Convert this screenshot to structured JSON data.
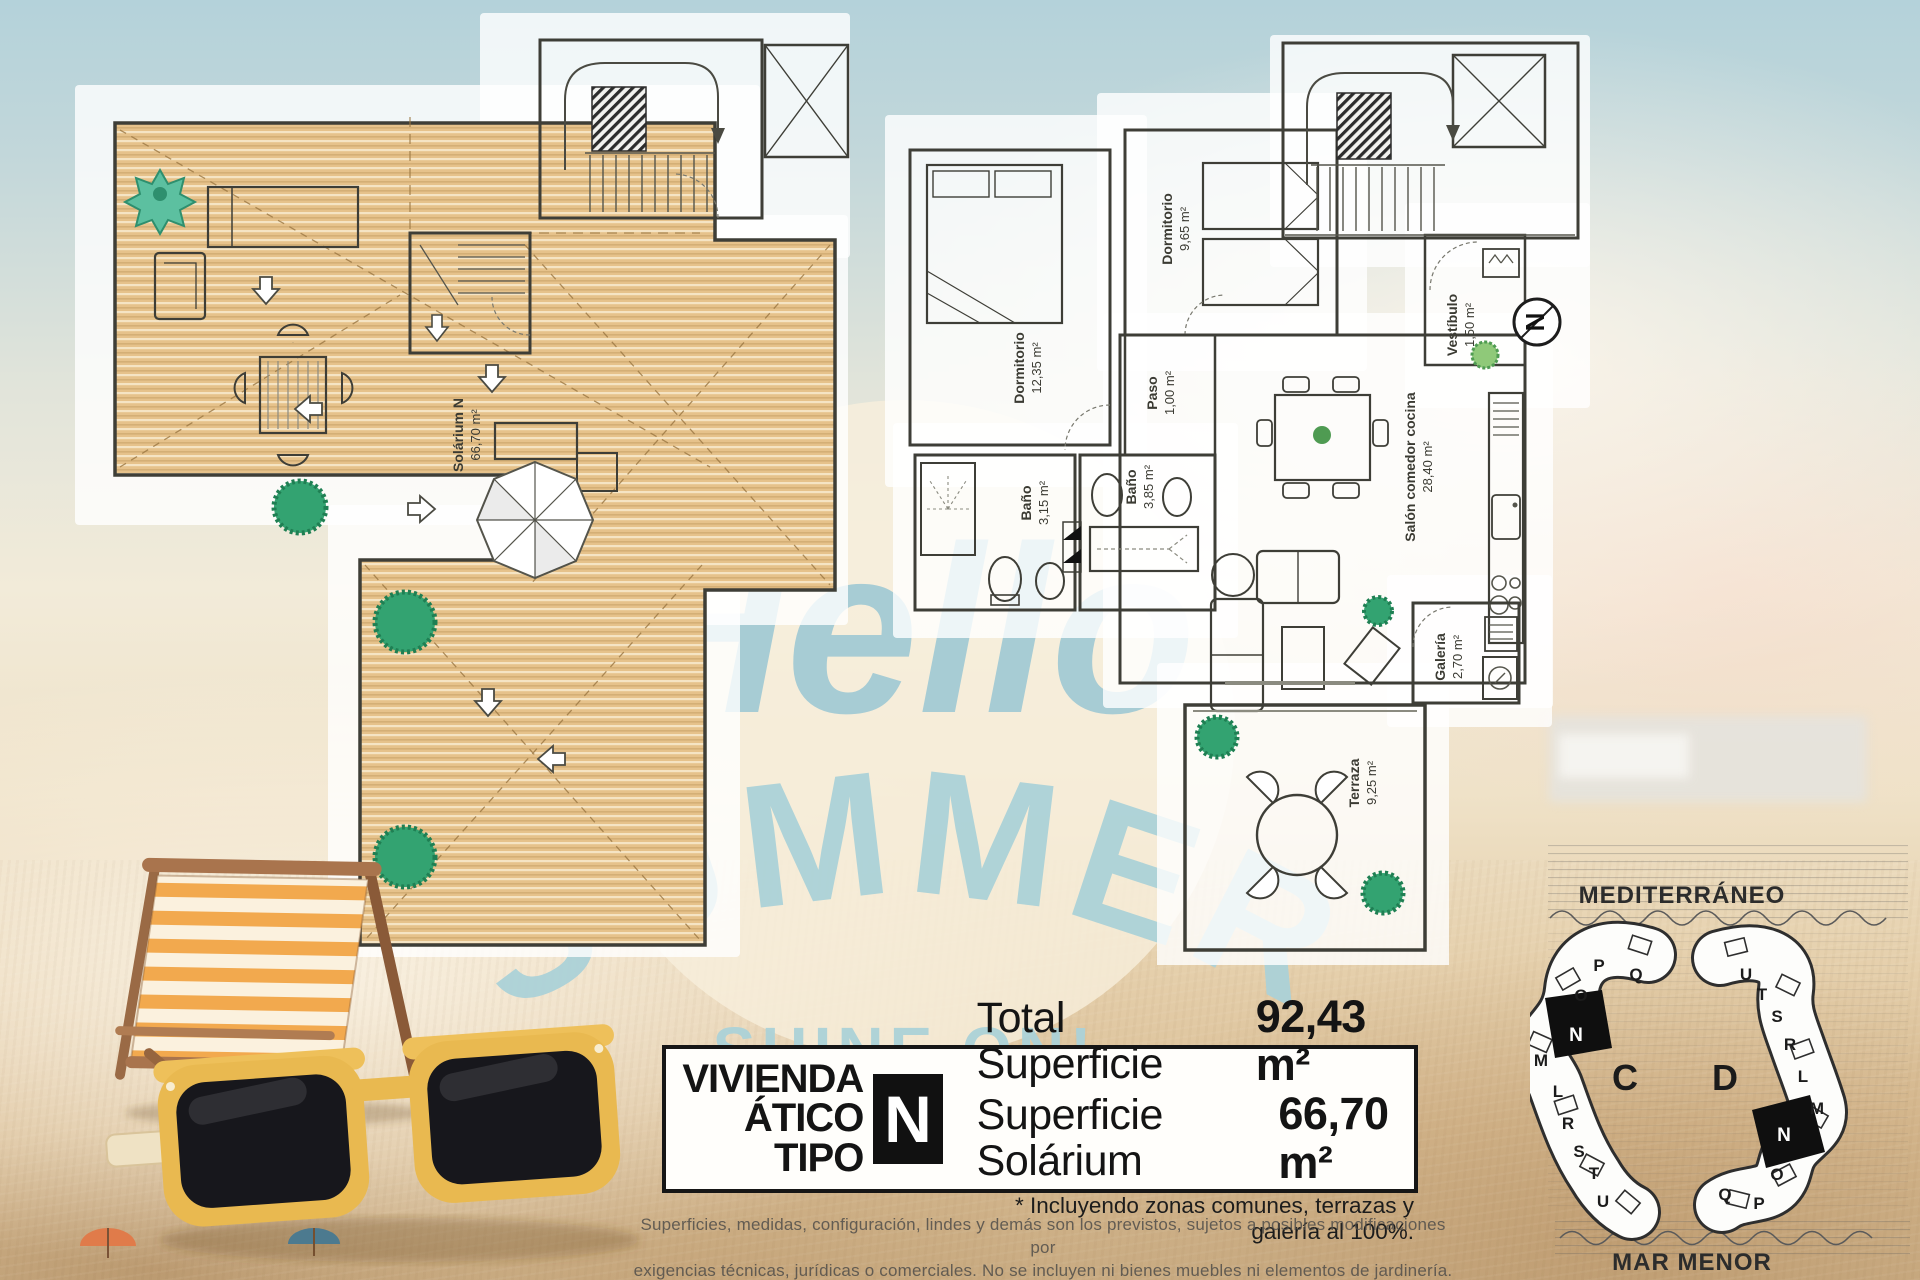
{
  "colors": {
    "watermark_blue": "#9cc6d2",
    "wood": "#e6c28b",
    "sky": "#b4d2da",
    "sand": "#d8bc93",
    "highlight_black": "#111111"
  },
  "watermark": {
    "hello": "Hello",
    "summer": "SUMMER",
    "shine_on": "-SHINE ON!-"
  },
  "solarium_plan": {
    "room_label": "Solárium N",
    "room_area": "66,70 m²"
  },
  "apartment_plan": {
    "compass_letter": "N",
    "rooms": {
      "dormitorio_1": {
        "name": "Dormitorio",
        "area": "12,35 m²"
      },
      "dormitorio_2": {
        "name": "Dormitorio",
        "area": "9,65 m²"
      },
      "paso": {
        "name": "Paso",
        "area": "1,00 m²"
      },
      "bano_1": {
        "name": "Baño",
        "area": "3,15 m²"
      },
      "bano_2": {
        "name": "Baño",
        "area": "3,85 m²"
      },
      "salon": {
        "name": "Salón comedor cocina",
        "area": "28,40 m²"
      },
      "vestibulo": {
        "name": "Vestíbulo",
        "area": "1,50 m²"
      },
      "galeria": {
        "name": "Galería",
        "area": "2,70 m²"
      },
      "terraza": {
        "name": "Terraza",
        "area": "9,25 m²"
      }
    }
  },
  "info_box": {
    "title_line1": "VIVIENDA",
    "title_line2": "ÁTICO TIPO",
    "type_letter": "N",
    "total_label": "Total Superficie",
    "total_value": "92,43 m²",
    "solarium_label": "Superficie Solárium",
    "solarium_value": "66,70 m²",
    "footnote": "* Incluyendo zonas comunes, terrazas y galería al 100%."
  },
  "disclaimer": {
    "line1": "Superficies, medidas, configuración, lindes y demás son los previstos, sujetos a posibles modificaciones por",
    "line2": "exigencias técnicas, jurídicas o comerciales. No se incluyen ni bienes muebles ni elementos de jardinería."
  },
  "site_plan": {
    "sea_top": "MEDITERRÁNEO",
    "sea_bottom": "MAR MENOR",
    "block_c": {
      "label": "C",
      "units": [
        "P",
        "Q",
        "O",
        "N",
        "M",
        "L",
        "R",
        "S",
        "T",
        "U"
      ],
      "highlight": "N"
    },
    "block_d": {
      "label": "D",
      "units": [
        "U",
        "T",
        "S",
        "R",
        "L",
        "M",
        "N",
        "O",
        "Q",
        "P"
      ],
      "highlight": "N"
    }
  }
}
